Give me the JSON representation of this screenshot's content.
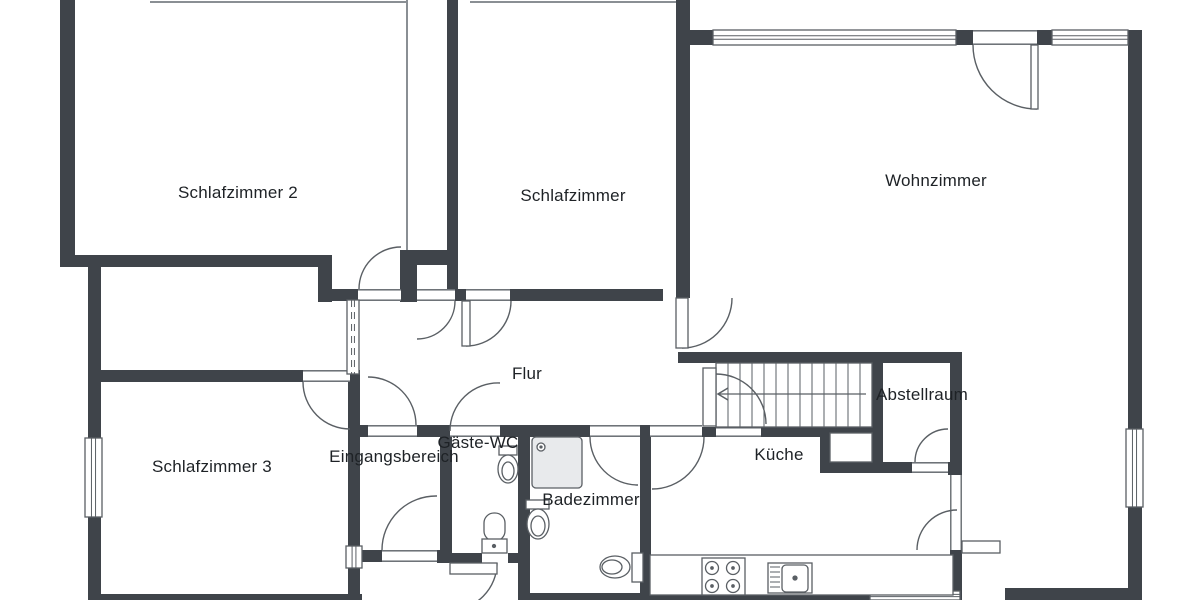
{
  "title": "Wohnung Grundriss",
  "colors": {
    "wall": "#3f444a",
    "line": "#5a5f64",
    "thin": "#8a8f94",
    "text": "#1e2226",
    "shower_fill": "#e8eaec",
    "paper": "#ffffff"
  },
  "rooms": [
    {
      "id": "schlafzimmer-2",
      "label": "Schlafzimmer 2"
    },
    {
      "id": "schlafzimmer",
      "label": "Schlafzimmer"
    },
    {
      "id": "wohnzimmer",
      "label": "Wohnzimmer"
    },
    {
      "id": "flur",
      "label": "Flur"
    },
    {
      "id": "schlafzimmer-3",
      "label": "Schlafzimmer 3"
    },
    {
      "id": "eingangsbereich",
      "label": "Eingangsbereich"
    },
    {
      "id": "gaeste-wc",
      "label": "Gäste-WC"
    },
    {
      "id": "badezimmer",
      "label": "Badezimmer"
    },
    {
      "id": "kueche",
      "label": "Küche"
    },
    {
      "id": "abstellraum",
      "label": "Abstellraum"
    }
  ],
  "plan": {
    "canvas": {
      "w": 1200,
      "h": 600
    },
    "walls": [
      [
        60,
        0,
        15,
        267
      ],
      [
        60,
        255,
        272,
        12
      ],
      [
        318,
        255,
        14,
        47
      ],
      [
        332,
        289,
        26,
        12
      ],
      [
        400,
        250,
        47,
        15
      ],
      [
        400,
        265,
        17,
        37
      ],
      [
        447,
        0,
        11,
        292
      ],
      [
        455,
        289,
        11,
        12
      ],
      [
        510,
        289,
        153,
        12
      ],
      [
        676,
        0,
        14,
        298
      ],
      [
        690,
        30,
        23,
        15
      ],
      [
        956,
        30,
        17,
        15
      ],
      [
        1037,
        30,
        15,
        15
      ],
      [
        1128,
        30,
        14,
        399
      ],
      [
        1128,
        507,
        14,
        93
      ],
      [
        1005,
        588,
        123,
        12
      ],
      [
        678,
        352,
        282,
        11
      ],
      [
        872,
        363,
        11,
        99
      ],
      [
        702,
        427,
        14,
        10
      ],
      [
        761,
        427,
        62,
        10
      ],
      [
        820,
        427,
        10,
        46
      ],
      [
        823,
        427,
        49,
        6
      ],
      [
        820,
        462,
        92,
        11
      ],
      [
        948,
        462,
        14,
        13
      ],
      [
        950,
        352,
        12,
        123
      ],
      [
        950,
        550,
        12,
        50
      ],
      [
        88,
        267,
        13,
        171
      ],
      [
        88,
        517,
        13,
        83
      ],
      [
        88,
        370,
        215,
        12
      ],
      [
        350,
        370,
        10,
        12
      ],
      [
        348,
        382,
        12,
        164
      ],
      [
        348,
        568,
        12,
        32
      ],
      [
        88,
        594,
        274,
        6
      ],
      [
        360,
        425,
        8,
        12
      ],
      [
        417,
        425,
        33,
        12
      ],
      [
        500,
        425,
        90,
        12
      ],
      [
        640,
        425,
        10,
        12
      ],
      [
        440,
        437,
        12,
        116
      ],
      [
        518,
        425,
        12,
        175
      ],
      [
        640,
        425,
        11,
        175
      ],
      [
        360,
        550,
        22,
        12
      ],
      [
        437,
        550,
        14,
        13
      ],
      [
        451,
        553,
        31,
        10
      ],
      [
        508,
        553,
        10,
        10
      ],
      [
        528,
        593,
        122,
        7
      ],
      [
        650,
        594,
        220,
        6
      ]
    ],
    "thin_lines": [
      [
        150,
        2,
        406,
        2
      ],
      [
        470,
        2,
        676,
        2
      ],
      [
        407,
        0,
        407,
        250
      ]
    ],
    "openings": [
      [
        358,
        289,
        43,
        12,
        "h"
      ],
      [
        417,
        289,
        38,
        12,
        "h"
      ],
      [
        466,
        289,
        44,
        12,
        "h"
      ],
      [
        303,
        370,
        47,
        12,
        "h"
      ],
      [
        368,
        425,
        49,
        12,
        "h"
      ],
      [
        450,
        425,
        50,
        12,
        "h"
      ],
      [
        590,
        425,
        50,
        12,
        "h"
      ],
      [
        650,
        425,
        52,
        12,
        "h"
      ],
      [
        716,
        427,
        45,
        10,
        "h"
      ],
      [
        912,
        462,
        36,
        11,
        "h"
      ],
      [
        950,
        475,
        12,
        38,
        "v"
      ],
      [
        950,
        513,
        12,
        37,
        "v"
      ],
      [
        382,
        550,
        55,
        12,
        "h"
      ],
      [
        973,
        30,
        64,
        15,
        "h"
      ],
      [
        830,
        433,
        42,
        29,
        "b"
      ]
    ],
    "windows": [
      {
        "r": [
          713,
          30,
          243,
          15
        ],
        "o": "h"
      },
      {
        "r": [
          1052,
          30,
          76,
          15
        ],
        "o": "h"
      },
      {
        "r": [
          1126,
          429,
          17,
          78
        ],
        "o": "v"
      },
      {
        "r": [
          85,
          438,
          17,
          79
        ],
        "o": "v"
      },
      {
        "r": [
          870,
          591,
          90,
          9
        ],
        "o": "h"
      },
      {
        "r": [
          346,
          546,
          16,
          22
        ],
        "o": "v"
      },
      {
        "r": [
          347,
          300,
          12,
          74
        ],
        "o": "v",
        "dashed": true
      }
    ],
    "leaves": [
      [
        703,
        368,
        13,
        58
      ],
      [
        462,
        301,
        8,
        45
      ],
      [
        676,
        298,
        12,
        50
      ],
      [
        1031,
        45,
        7,
        64
      ],
      [
        962,
        541,
        38,
        12
      ],
      [
        450,
        563,
        47,
        11
      ]
    ],
    "arcs": [
      "M 359,289 A 42 42 0 0 1 401,247",
      "M 455,301 A 38 38 0 0 1 417,339",
      "M 466,346 A 45 45 0 0 0 511,301",
      "M 682,348 A 50 50 0 0 0 732,298",
      "M 1037,109 A 64 64 0 0 1 973,45",
      "M 948,429 A 33 33 0 0 0 915,462",
      "M 917,550 A 40 40 0 0 1 957,510",
      "M 704,437 A 52 52 0 0 1 652,489",
      "M 590,437 A 48 48 0 0 0 638,485",
      "M 368,377 A 48 48 0 0 1 416,425",
      "M 500,383 A 48 48 0 0 0 450,431",
      "M 303,382 A 47 47 0 0 0 350,429",
      "M 437,496 A 54 54 0 0 0 382,550",
      "M 497,563 A 47 47 0 0 1 450,610",
      "M 716,374 A 50 50 0 0 1 766,424"
    ],
    "stairs": {
      "box": [
        716,
        363,
        156,
        64
      ],
      "step_x_start": 728,
      "step_dx": 12,
      "step_count": 12,
      "walkline": [
        718,
        394,
        866,
        394
      ],
      "arrow": "728,388 718,394 728,400"
    },
    "fixtures": [
      {
        "t": "rect",
        "n": "shower",
        "x": 532,
        "y": 437,
        "w": 50,
        "h": 51,
        "rx": 4,
        "fill": "#e8eaec"
      },
      {
        "t": "circle",
        "n": "shower-drain",
        "cx": 541,
        "cy": 447,
        "r": 4
      },
      {
        "t": "circle",
        "n": "shower-drain-dot",
        "cx": 541,
        "cy": 447,
        "r": 1
      },
      {
        "t": "rect",
        "n": "wc-tank",
        "x": 526,
        "y": 500,
        "w": 23,
        "h": 9
      },
      {
        "t": "ellipse",
        "n": "wc-bowl",
        "cx": 538,
        "cy": 524,
        "rx": 11,
        "ry": 15
      },
      {
        "t": "ellipse",
        "n": "wc-bowl-inner",
        "cx": 538,
        "cy": 526,
        "rx": 7,
        "ry": 10
      },
      {
        "t": "rect",
        "n": "wc2-tank",
        "x": 632,
        "y": 553,
        "w": 11,
        "h": 29
      },
      {
        "t": "ellipse",
        "n": "wc2-bowl",
        "cx": 615,
        "cy": 567,
        "rx": 15,
        "ry": 11
      },
      {
        "t": "ellipse",
        "n": "wc2-bowl-inner",
        "cx": 612,
        "cy": 567,
        "rx": 10,
        "ry": 7
      },
      {
        "t": "rect",
        "n": "gwc-tank",
        "x": 499,
        "y": 446,
        "w": 18,
        "h": 9
      },
      {
        "t": "ellipse",
        "n": "gwc-bowl",
        "cx": 508,
        "cy": 469,
        "rx": 10,
        "ry": 14
      },
      {
        "t": "ellipse",
        "n": "gwc-bowl-inner",
        "cx": 508,
        "cy": 471,
        "rx": 6,
        "ry": 9
      },
      {
        "t": "rect",
        "n": "gwc-sink-top",
        "x": 484,
        "y": 513,
        "w": 21,
        "h": 28,
        "rx": 10
      },
      {
        "t": "rect",
        "n": "gwc-sink-base",
        "x": 482,
        "y": 539,
        "w": 25,
        "h": 14
      },
      {
        "t": "circle",
        "n": "gwc-sink-dot",
        "cx": 494,
        "cy": 546,
        "r": 1.5
      },
      {
        "t": "rect",
        "n": "counter",
        "x": 650,
        "y": 555,
        "w": 303,
        "h": 40
      },
      {
        "t": "rect",
        "n": "stove",
        "x": 702,
        "y": 558,
        "w": 43,
        "h": 37
      },
      {
        "t": "circle",
        "n": "burner",
        "cx": 712,
        "cy": 568,
        "r": 6.5
      },
      {
        "t": "circle",
        "n": "burner",
        "cx": 733,
        "cy": 568,
        "r": 6.5
      },
      {
        "t": "circle",
        "n": "burner",
        "cx": 712,
        "cy": 586,
        "r": 6.5
      },
      {
        "t": "circle",
        "n": "burner",
        "cx": 733,
        "cy": 586,
        "r": 6.5
      },
      {
        "t": "circle",
        "n": "burner-dot",
        "cx": 712,
        "cy": 568,
        "r": 1.2
      },
      {
        "t": "circle",
        "n": "burner-dot",
        "cx": 733,
        "cy": 568,
        "r": 1.2
      },
      {
        "t": "circle",
        "n": "burner-dot",
        "cx": 712,
        "cy": 586,
        "r": 1.2
      },
      {
        "t": "circle",
        "n": "burner-dot",
        "cx": 733,
        "cy": 586,
        "r": 1.2
      },
      {
        "t": "rect",
        "n": "sink-unit",
        "x": 768,
        "y": 563,
        "w": 44,
        "h": 30
      },
      {
        "t": "rect",
        "n": "sink-basin",
        "x": 782,
        "y": 565,
        "w": 26,
        "h": 27,
        "rx": 4
      },
      {
        "t": "circle",
        "n": "sink-dot",
        "cx": 795,
        "cy": 578,
        "r": 2
      },
      {
        "t": "line",
        "n": "drainer",
        "x1": 770,
        "y1": 567,
        "x2": 780,
        "y2": 567
      },
      {
        "t": "line",
        "n": "drainer",
        "x1": 770,
        "y1": 572,
        "x2": 780,
        "y2": 572
      },
      {
        "t": "line",
        "n": "drainer",
        "x1": 770,
        "y1": 577,
        "x2": 780,
        "y2": 577
      },
      {
        "t": "line",
        "n": "drainer",
        "x1": 770,
        "y1": 582,
        "x2": 780,
        "y2": 582
      },
      {
        "t": "line",
        "n": "drainer",
        "x1": 770,
        "y1": 587,
        "x2": 780,
        "y2": 587
      }
    ]
  }
}
